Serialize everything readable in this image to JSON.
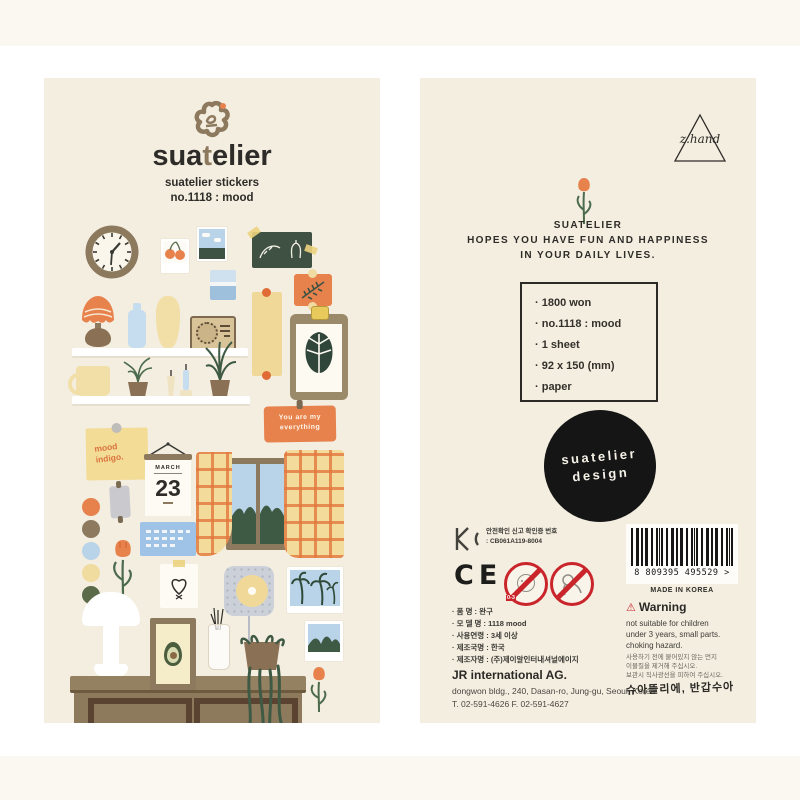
{
  "front": {
    "brand_pre": "sua",
    "brand_t": "t",
    "brand_post": "elier",
    "subtitle_line1": "suatelier stickers",
    "subtitle_line2": "no.1118 : mood",
    "stickers": {
      "orange_note_line1": "You are my",
      "orange_note_line2": "everything",
      "yellow_note_line1": "mood",
      "yellow_note_line2": "indigo.",
      "calendar_month": "MARCH",
      "calendar_day": "23"
    }
  },
  "back": {
    "corner_logo": "z.hand",
    "message_line1": "SUATELIER",
    "message_line2": "HOPES YOU HAVE FUN AND HAPPINESS",
    "message_line3": "IN YOUR DAILY LIVES.",
    "info_box_items": [
      "· 1800 won",
      "· no.1118 : mood",
      "· 1 sheet",
      "· 92 x 150 (mm)",
      "· paper"
    ],
    "badge_line1": "suatelier",
    "badge_line2": "design",
    "kc_label": "안전확인 신고 확인증 번호",
    "kc_number": ": CB061A119-8004",
    "ce_mark": "CE",
    "age_range": "0-3",
    "barcode_digits": "8 809395 495529 >",
    "made_in": "MADE IN KOREA",
    "product_rows": [
      "· 품      명 : 완구",
      "· 모 델 명 : 1118 mood",
      "· 사용연령 : 3세 이상",
      "· 제조국명 : 한국",
      "· 제조자명 : (주)제이알인터내셔널에이지"
    ],
    "company": "JR international AG.",
    "address": "dongwon bldg., 240, Dasan-ro, Jung-gu, Seoul, Korea",
    "phones": "T. 02-591-4626   F. 02-591-4627",
    "warning_icon": "⚠",
    "warning_title": "Warning",
    "warning_en": [
      "not suitable for children",
      "under 3 years, small parts.",
      "choking hazard."
    ],
    "warning_ko": [
      "사용하기 전에 붙어있지 않는 먼지",
      "이물질을 제거해 주십시오.",
      "보관시 직사광선을 피하여 주십시오."
    ],
    "closing_handwriting": "슈아뜰리에, 반갑수아"
  },
  "colors": {
    "panel_cream": "#f4eee1",
    "accent_orange": "#e8824d",
    "brown": "#8d7a5e",
    "dark_green": "#3d5243",
    "light_blue": "#b9d3e8",
    "soft_yellow": "#f0d998",
    "warning_red": "#c9252b",
    "badge_black": "#151515"
  }
}
